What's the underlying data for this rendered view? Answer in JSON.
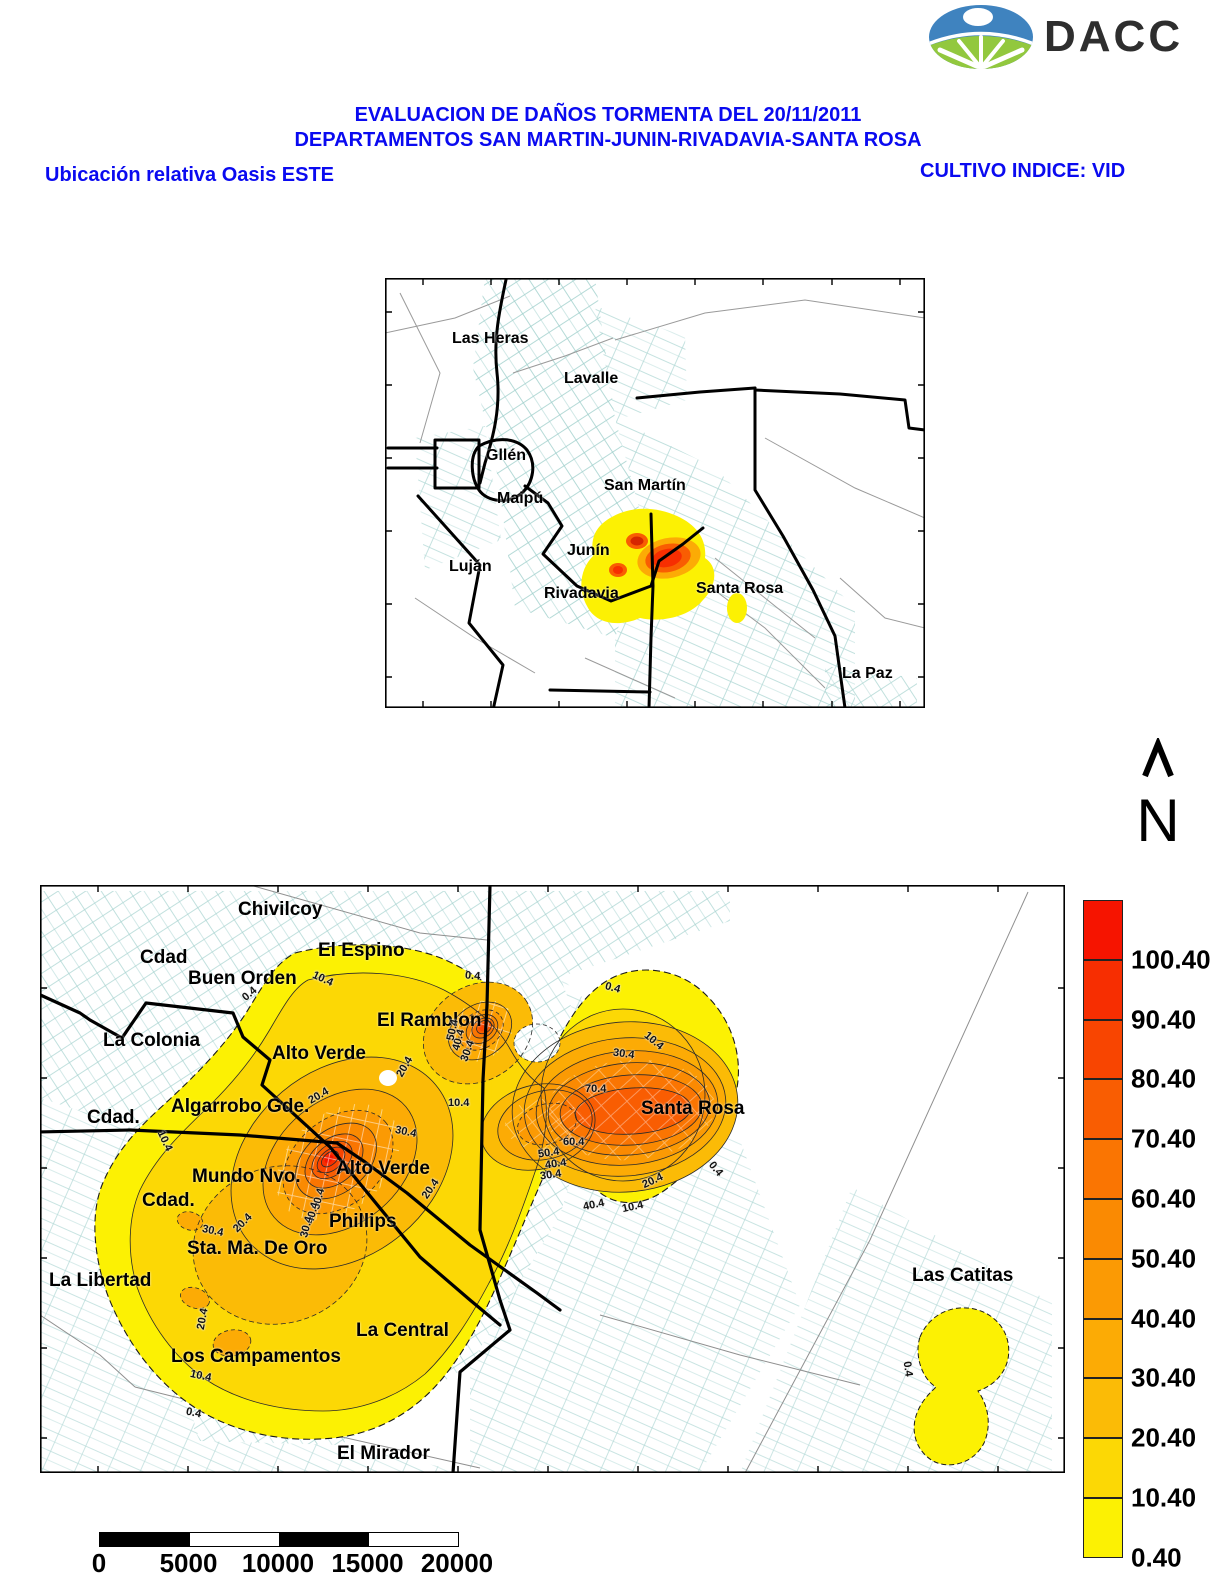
{
  "header": {
    "logo_text": "DACC",
    "title_line1": "EVALUACION DE DAÑOS TORMENTA DEL 20/11/2011",
    "title_line2": "DEPARTAMENTOS SAN MARTIN-JUNIN-RIVADAVIA-SANTA ROSA",
    "left_caption": "Ubicación relativa Oasis ESTE",
    "right_caption": "CULTIVO INDICE: VID",
    "accent_color": "#0a0af0"
  },
  "north": {
    "label": "N"
  },
  "locator_map": {
    "labels": [
      {
        "text": "Las Heras",
        "x": 67,
        "y": 52
      },
      {
        "text": "Lavalle",
        "x": 179,
        "y": 92
      },
      {
        "text": "Gllén",
        "x": 101,
        "y": 169
      },
      {
        "text": "Maipú",
        "x": 112,
        "y": 212
      },
      {
        "text": "San Martín",
        "x": 219,
        "y": 199
      },
      {
        "text": "Junín",
        "x": 182,
        "y": 264
      },
      {
        "text": "Luján",
        "x": 64,
        "y": 280
      },
      {
        "text": "Rivadavia",
        "x": 159,
        "y": 307
      },
      {
        "text": "Santa Rosa",
        "x": 311,
        "y": 302
      },
      {
        "text": "La Paz",
        "x": 457,
        "y": 387
      }
    ]
  },
  "main_map": {
    "labels": [
      {
        "text": "Chivilcoy",
        "x": 198,
        "y": 14
      },
      {
        "text": "Cdad",
        "x": 100,
        "y": 62
      },
      {
        "text": "El Espino",
        "x": 278,
        "y": 55
      },
      {
        "text": "Buen Orden",
        "x": 148,
        "y": 83
      },
      {
        "text": "La Colonia",
        "x": 63,
        "y": 145
      },
      {
        "text": "El Ramblon",
        "x": 337,
        "y": 125
      },
      {
        "text": "Alto Verde",
        "x": 232,
        "y": 158
      },
      {
        "text": "Cdad.",
        "x": 47,
        "y": 222
      },
      {
        "text": "Algarrobo Gde.",
        "x": 131,
        "y": 211
      },
      {
        "text": "Mundo Nvo.",
        "x": 152,
        "y": 281
      },
      {
        "text": "Alto Verde",
        "x": 296,
        "y": 273
      },
      {
        "text": "Cdad.",
        "x": 102,
        "y": 305
      },
      {
        "text": "Phillips",
        "x": 289,
        "y": 326
      },
      {
        "text": "Sta. Ma. De Oro",
        "x": 147,
        "y": 353
      },
      {
        "text": "La Libertad",
        "x": 9,
        "y": 385
      },
      {
        "text": "Santa Rosa",
        "x": 601,
        "y": 213
      },
      {
        "text": "Las Catitas",
        "x": 872,
        "y": 380
      },
      {
        "text": "La Central",
        "x": 316,
        "y": 435
      },
      {
        "text": "Los Campamentos",
        "x": 131,
        "y": 461
      },
      {
        "text": "El Mirador",
        "x": 297,
        "y": 558
      }
    ],
    "contour_labels": [
      {
        "text": "0.4",
        "x": 202,
        "y": 103,
        "rot": -40
      },
      {
        "text": "10.4",
        "x": 272,
        "y": 88,
        "rot": 25
      },
      {
        "text": "0.4",
        "x": 425,
        "y": 85,
        "rot": 5
      },
      {
        "text": "0.4",
        "x": 565,
        "y": 97,
        "rot": 15
      },
      {
        "text": "10.4",
        "x": 603,
        "y": 150,
        "rot": 40
      },
      {
        "text": "30.4",
        "x": 573,
        "y": 163,
        "rot": 8
      },
      {
        "text": "70.4",
        "x": 545,
        "y": 198,
        "rot": 0
      },
      {
        "text": "60.4",
        "x": 523,
        "y": 251,
        "rot": 0
      },
      {
        "text": "50.4",
        "x": 498,
        "y": 262,
        "rot": -8
      },
      {
        "text": "40.4",
        "x": 505,
        "y": 273,
        "rot": -8
      },
      {
        "text": "30.4",
        "x": 500,
        "y": 284,
        "rot": -8
      },
      {
        "text": "40.4",
        "x": 543,
        "y": 314,
        "rot": -12
      },
      {
        "text": "10.4",
        "x": 582,
        "y": 316,
        "rot": -12
      },
      {
        "text": "0.4",
        "x": 668,
        "y": 278,
        "rot": 50
      },
      {
        "text": "20.4",
        "x": 602,
        "y": 290,
        "rot": -25
      },
      {
        "text": "20.4",
        "x": 354,
        "y": 176,
        "rot": -60
      },
      {
        "text": "10.4",
        "x": 408,
        "y": 212,
        "rot": 0
      },
      {
        "text": "30.4",
        "x": 355,
        "y": 241,
        "rot": 12
      },
      {
        "text": "20.4",
        "x": 268,
        "y": 205,
        "rot": -30
      },
      {
        "text": "30.4",
        "x": 417,
        "y": 160,
        "rot": -70
      },
      {
        "text": "40.4",
        "x": 408,
        "y": 149,
        "rot": -75
      },
      {
        "text": "50.4",
        "x": 402,
        "y": 139,
        "rot": -78
      },
      {
        "text": "20.4",
        "x": 380,
        "y": 298,
        "rot": -55
      },
      {
        "text": "50.4",
        "x": 268,
        "y": 308,
        "rot": -75
      },
      {
        "text": "40.4",
        "x": 262,
        "y": 322,
        "rot": -75
      },
      {
        "text": "30.4",
        "x": 256,
        "y": 336,
        "rot": -75
      },
      {
        "text": "10.4",
        "x": 114,
        "y": 250,
        "rot": 65
      },
      {
        "text": "30.4",
        "x": 162,
        "y": 340,
        "rot": 12
      },
      {
        "text": "20.4",
        "x": 192,
        "y": 332,
        "rot": -45
      },
      {
        "text": "20.4",
        "x": 152,
        "y": 428,
        "rot": -80
      },
      {
        "text": "10.4",
        "x": 150,
        "y": 485,
        "rot": 12
      },
      {
        "text": "0.4",
        "x": 146,
        "y": 522,
        "rot": 12
      },
      {
        "text": "0.4",
        "x": 860,
        "y": 478,
        "rot": 82
      }
    ]
  },
  "legend": {
    "segments": [
      {
        "color": "#f61400",
        "label": "100.40"
      },
      {
        "color": "#f72e01",
        "label": "90.40"
      },
      {
        "color": "#f84501",
        "label": "80.40"
      },
      {
        "color": "#f95d02",
        "label": "70.40"
      },
      {
        "color": "#fa7502",
        "label": "60.40"
      },
      {
        "color": "#fa8a02",
        "label": "50.40"
      },
      {
        "color": "#fb9a04",
        "label": "40.40"
      },
      {
        "color": "#fcab05",
        "label": "30.40"
      },
      {
        "color": "#fbbb06",
        "label": "20.40"
      },
      {
        "color": "#fcd805",
        "label": "10.40"
      },
      {
        "color": "#fcf103",
        "label": "0.40"
      }
    ]
  },
  "scalebar": {
    "labels": [
      "0",
      "5000",
      "10000",
      "15000",
      "20000"
    ]
  }
}
